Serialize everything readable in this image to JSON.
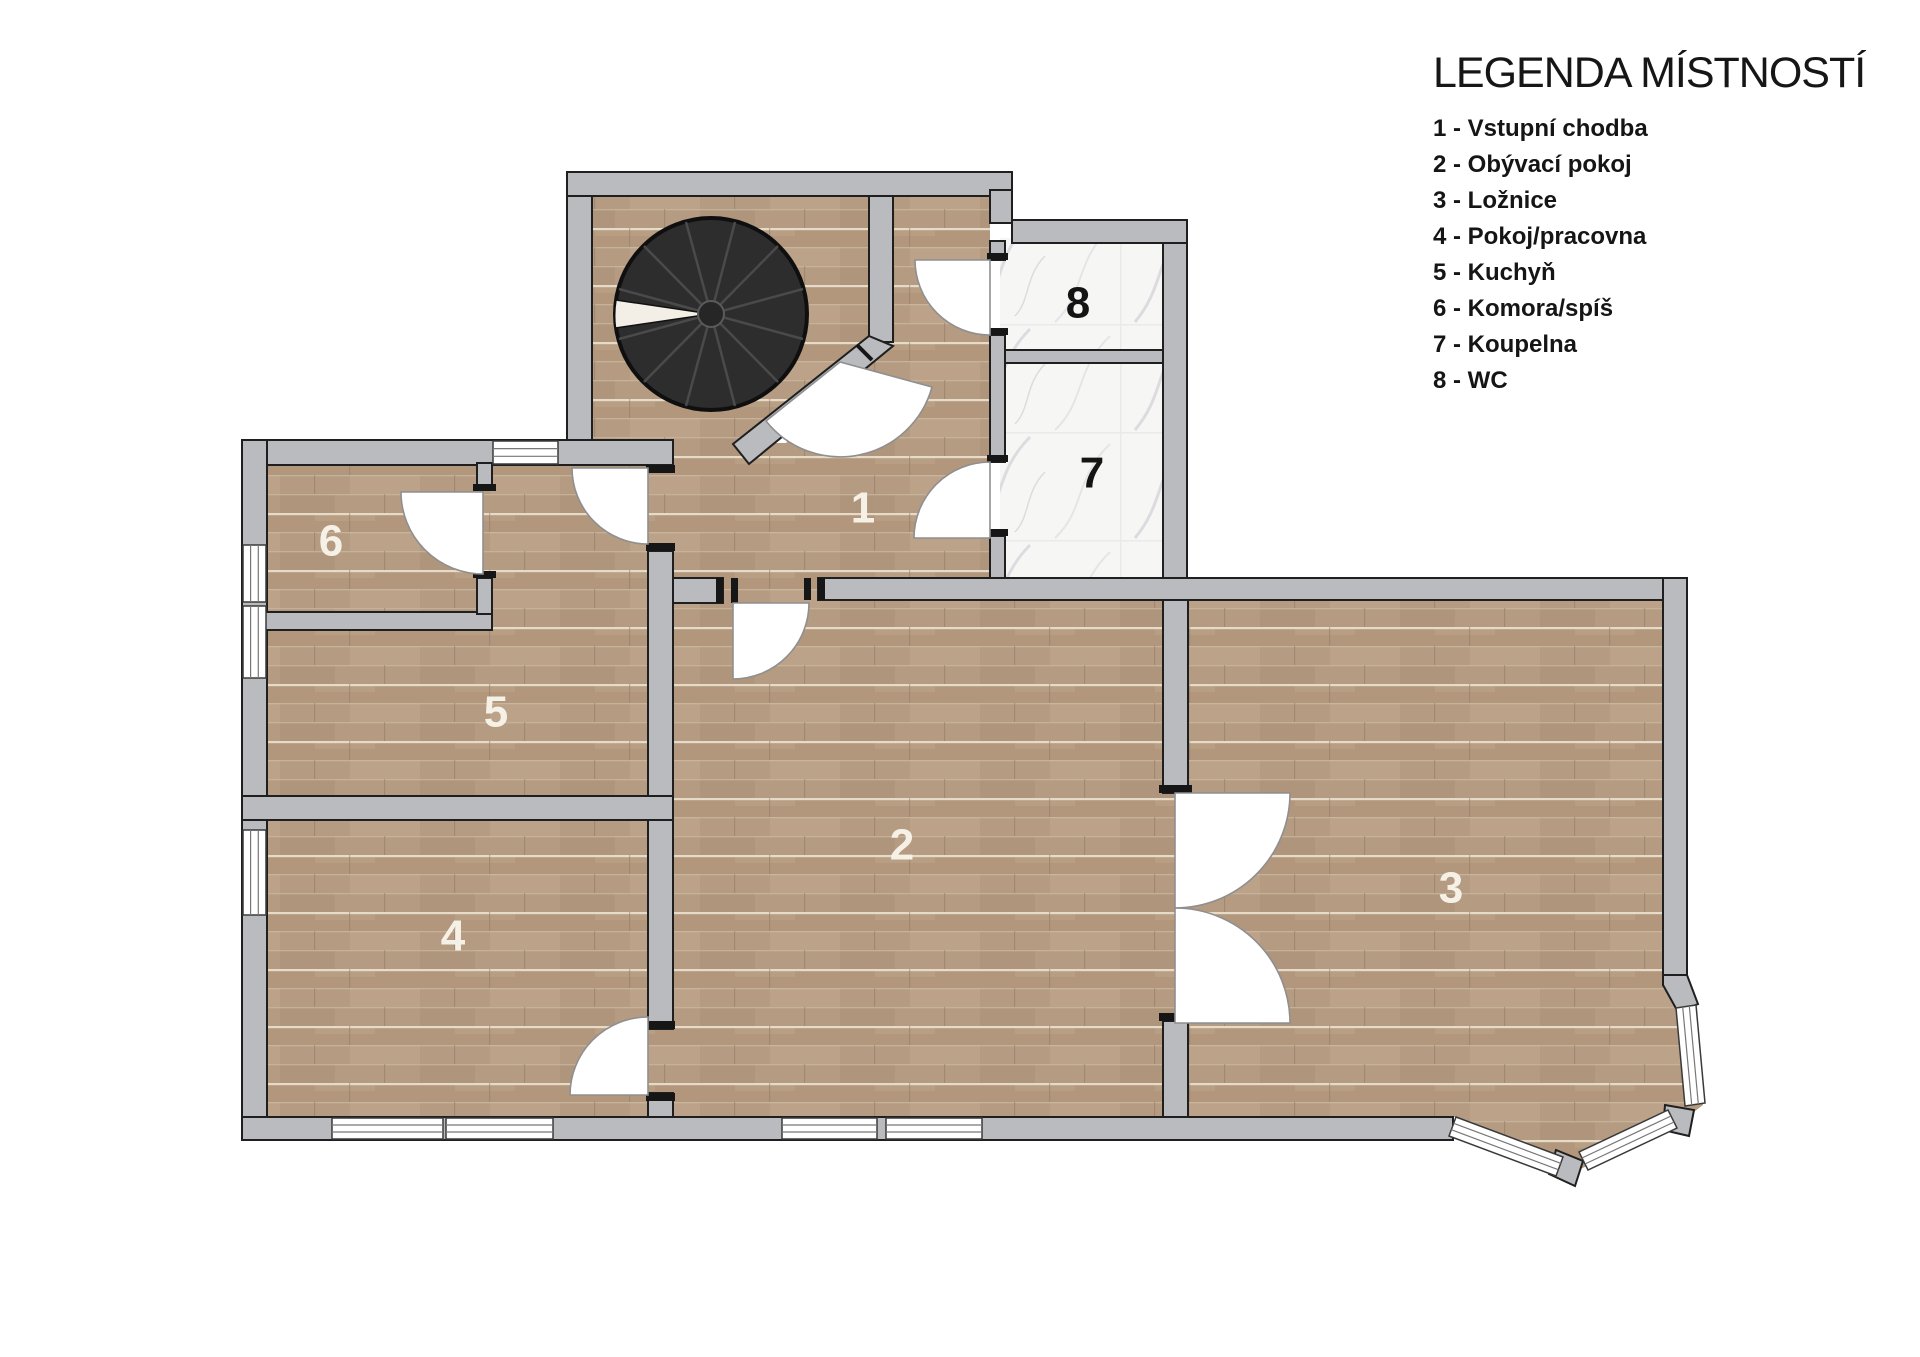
{
  "legend": {
    "title": "LEGENDA MÍSTNOSTÍ",
    "items": [
      "1 - Vstupní chodba",
      "2 - Obývací pokoj",
      "3 - Ložnice",
      "4 - Pokoj/pracovna",
      "5 - Kuchyň",
      "6 - Komora/spíš",
      "7 - Koupelna",
      "8 - WC"
    ]
  },
  "rooms": {
    "entry_hall": {
      "number": "1"
    },
    "living_room": {
      "number": "2"
    },
    "bedroom": {
      "number": "3"
    },
    "study": {
      "number": "4"
    },
    "kitchen": {
      "number": "5"
    },
    "pantry": {
      "number": "6"
    },
    "bathroom": {
      "number": "7"
    },
    "wc": {
      "number": "8"
    }
  },
  "colors": {
    "wall_gray": "#b9bbbe",
    "wood_floor": "#b59b81",
    "marble_floor": "#f6f6f5",
    "stair_black": "#2d2d2d",
    "label_light": "#f6f1e7",
    "label_dark": "#141414"
  }
}
